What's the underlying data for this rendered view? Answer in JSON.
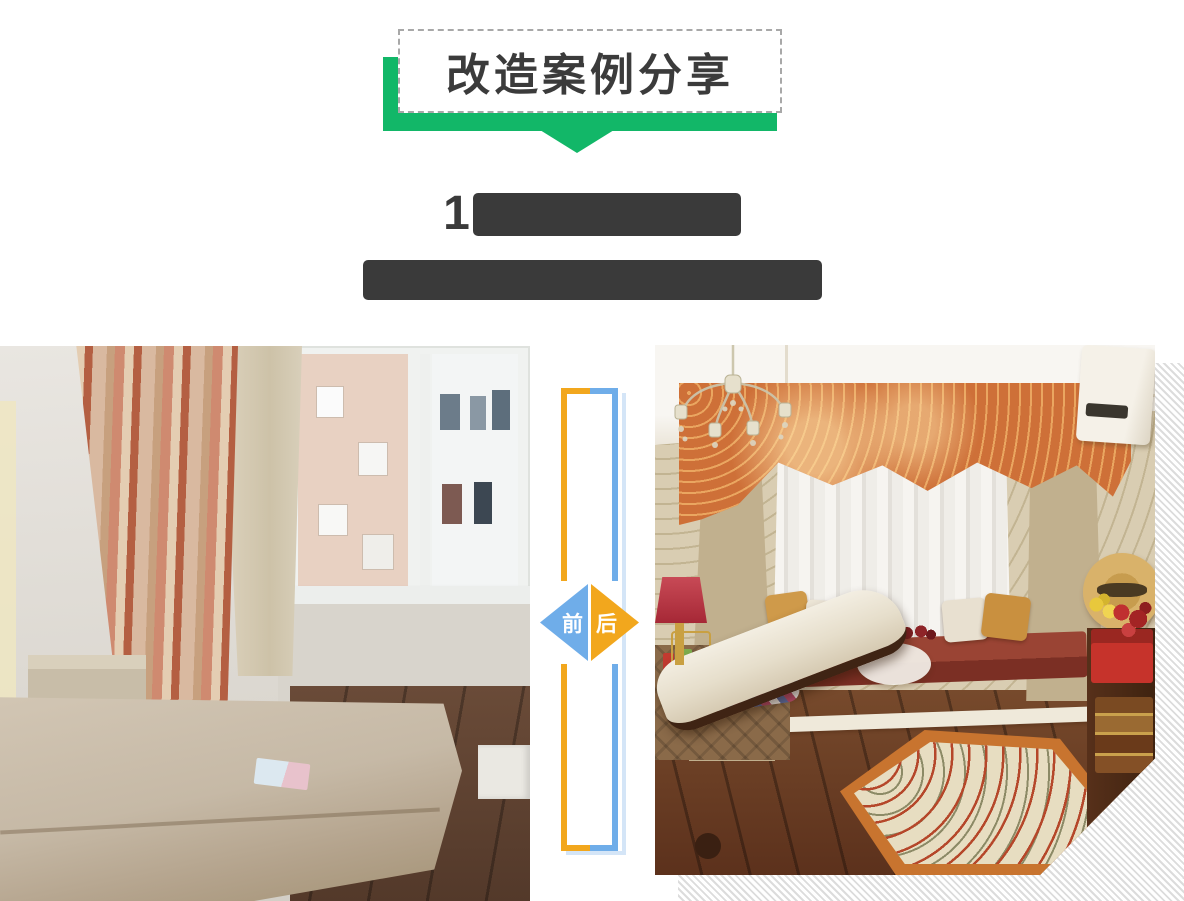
{
  "banner": {
    "title": "改造案例分享"
  },
  "heading": {
    "line1_prefix": "1",
    "line1_redacted": true,
    "line2_redacted": true
  },
  "comparison": {
    "before_label": "前",
    "after_label": "后"
  },
  "colors": {
    "green": "#12b768",
    "blue": "#6fade9",
    "orange": "#f2a71d",
    "shadow-blue": "#d4e5f7",
    "heading": "#3a3a3a"
  }
}
